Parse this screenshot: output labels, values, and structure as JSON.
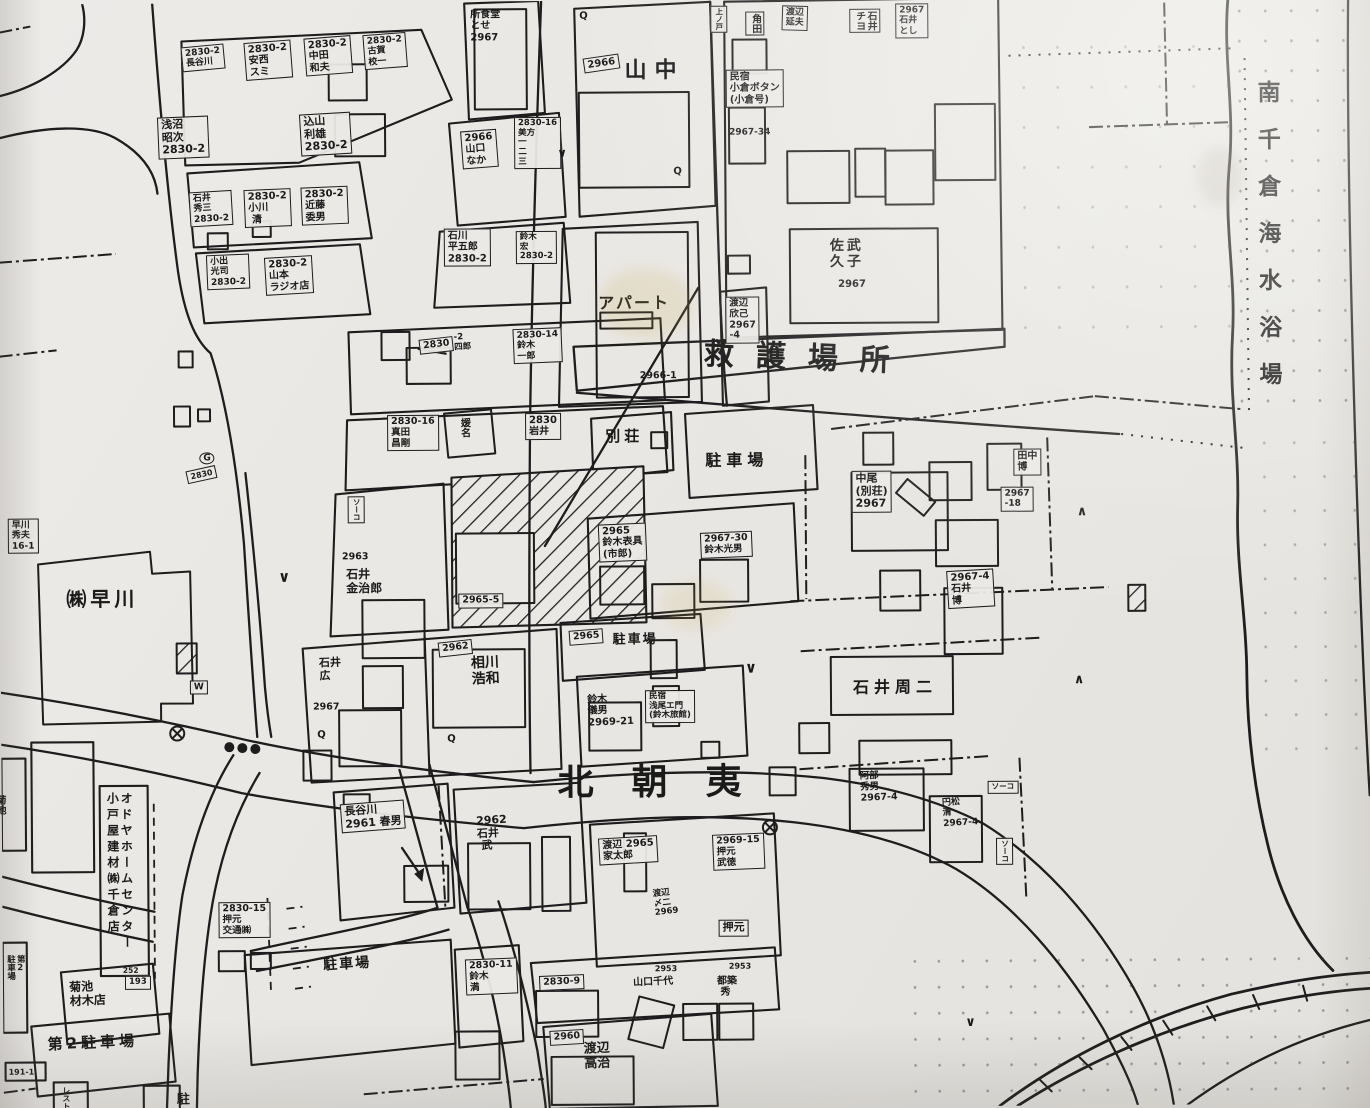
{
  "map": {
    "title": "南千倉住宅地図",
    "district_label": "北朝夷",
    "beach_label": "南千倉海水浴場",
    "labels": [
      {
        "t": "2830-2\n長谷川",
        "x": 184,
        "y": 44,
        "fs": 9,
        "b": 1,
        "r": -5
      },
      {
        "t": "2830-2\n安西\nスミ",
        "x": 247,
        "y": 40,
        "fs": 10,
        "b": 1,
        "r": -4
      },
      {
        "t": "2830-2\n中田\n和夫",
        "x": 307,
        "y": 36,
        "fs": 10,
        "b": 1,
        "r": -4
      },
      {
        "t": "2830-2\n古賀\n校一",
        "x": 366,
        "y": 33,
        "fs": 9,
        "b": 1,
        "r": -4
      },
      {
        "t": "浅沼\n昭次\n2830-2",
        "x": 160,
        "y": 114,
        "fs": 11,
        "b": 1,
        "r": -2
      },
      {
        "t": "込山\n利雄\n2830-2",
        "x": 302,
        "y": 112,
        "fs": 11,
        "b": 1,
        "r": -3
      },
      {
        "t": "石井\n秀三\n2830-2",
        "x": 191,
        "y": 189,
        "fs": 9,
        "b": 1,
        "r": -3
      },
      {
        "t": "2830-2\n小川\n 清",
        "x": 246,
        "y": 187,
        "fs": 10,
        "b": 1,
        "r": -2
      },
      {
        "t": "2830-2\n近藤\n委男",
        "x": 303,
        "y": 185,
        "fs": 10,
        "b": 1,
        "r": -2
      },
      {
        "t": "小出\n光司\n2830-2",
        "x": 208,
        "y": 252,
        "fs": 9,
        "b": 1,
        "r": -2
      },
      {
        "t": "2830-2\n山本\nラジオ店",
        "x": 266,
        "y": 255,
        "fs": 10,
        "b": 1,
        "r": -3
      },
      {
        "t": "2966\n山口\nなか",
        "x": 463,
        "y": 130,
        "fs": 10,
        "b": 1,
        "r": -4
      },
      {
        "t": "2830-16\n美方\n一\n二\n三",
        "x": 517,
        "y": 116,
        "fs": 8.5,
        "b": 1
      },
      {
        "t": "石川\n平五郎\n2830-2",
        "x": 446,
        "y": 227,
        "fs": 10,
        "b": 1
      },
      {
        "t": "鈴木\n宏\n2830-2",
        "x": 518,
        "y": 230,
        "fs": 8.5,
        "b": 1
      },
      {
        "t": "所食堂\nとせ\n2967",
        "x": 474,
        "y": 8,
        "fs": 10
      },
      {
        "t": "2966",
        "x": 586,
        "y": 58,
        "fs": 10,
        "b": 1,
        "r": -8
      },
      {
        "t": "山中",
        "x": 628,
        "y": 58,
        "fs": 22,
        "ls": 8
      },
      {
        "t": "上ノ戸",
        "x": 714,
        "y": 6,
        "fs": 7.5,
        "b": 1,
        "v": 1
      },
      {
        "t": "角田",
        "x": 749,
        "y": 12,
        "fs": 10,
        "b": 1,
        "v": 1
      },
      {
        "t": "渡辺\n延夫",
        "x": 786,
        "y": 6,
        "fs": 9,
        "b": 1,
        "r": 2
      },
      {
        "t": "石井\nチヨ",
        "x": 853,
        "y": 10,
        "fs": 10,
        "b": 1,
        "v": 1
      },
      {
        "t": "2967\n石井\nとし",
        "x": 899,
        "y": 5,
        "fs": 9,
        "b": 1
      },
      {
        "t": "民宿\n小倉ボタン\n(小倉号)",
        "x": 729,
        "y": 70,
        "fs": 10,
        "b": 1
      },
      {
        "t": "2967-34",
        "x": 732,
        "y": 128,
        "fs": 9
      },
      {
        "t": "佐武\n久子",
        "x": 832,
        "y": 240,
        "fs": 14,
        "ls": 3
      },
      {
        "t": "2967",
        "x": 840,
        "y": 280,
        "fs": 10
      },
      {
        "t": "南千倉海水浴場",
        "x": 1256,
        "y": 84,
        "fs": 23,
        "v": 1,
        "ls": 24,
        "n": "beach-label"
      },
      {
        "t": "2830",
        "x": 420,
        "y": 338,
        "fs": 9.5,
        "b": 1,
        "r": -6
      },
      {
        "t": "-2\n四郎",
        "x": 455,
        "y": 332,
        "fs": 8.5,
        "r": -3
      },
      {
        "t": "2830-14\n鈴木\n一郎",
        "x": 514,
        "y": 328,
        "fs": 9,
        "b": 1,
        "r": -2
      },
      {
        "t": "2966-1",
        "x": 641,
        "y": 371,
        "fs": 9.5
      },
      {
        "t": "2830-16\n真田\n昌剛",
        "x": 388,
        "y": 413,
        "fs": 9.5,
        "b": 1
      },
      {
        "t": "媛名",
        "x": 459,
        "y": 416,
        "fs": 10,
        "v": 1
      },
      {
        "t": "2830\n岩井",
        "x": 526,
        "y": 412,
        "fs": 10,
        "b": 1
      },
      {
        "t": "別荘",
        "x": 606,
        "y": 428,
        "fs": 15,
        "ls": 4
      },
      {
        "t": "駐車場",
        "x": 706,
        "y": 452,
        "fs": 16,
        "ls": 5,
        "n": "parking-label"
      },
      {
        "t": "渡辺\n欣己\n2967\n-4",
        "x": 727,
        "y": 297,
        "fs": 9.5,
        "b": 1
      },
      {
        "t": "救護場所",
        "x": 706,
        "y": 338,
        "fs": 30,
        "ls": 22,
        "r": 2.5,
        "n": "aid-station-label"
      },
      {
        "t": "ソーコ",
        "x": 348,
        "y": 494,
        "fs": 7.5,
        "b": 1,
        "v": 1
      },
      {
        "t": "2963",
        "x": 342,
        "y": 550,
        "fs": 9.5
      },
      {
        "t": "石井\n金治郎",
        "x": 346,
        "y": 566,
        "fs": 12
      },
      {
        "t": "2965-5",
        "x": 458,
        "y": 592,
        "fs": 9.5,
        "b": 1
      },
      {
        "t": "2965\n鈴木表具\n(市郎)",
        "x": 598,
        "y": 524,
        "fs": 10,
        "b": 1,
        "r": -2
      },
      {
        "t": "2967-30\n鈴木光男",
        "x": 700,
        "y": 533,
        "fs": 9.5,
        "b": 1,
        "r": -2
      },
      {
        "t": "中尾\n(別荘)\n2967",
        "x": 852,
        "y": 472,
        "fs": 11,
        "b": 1
      },
      {
        "t": "田中\n博",
        "x": 1014,
        "y": 451,
        "fs": 10,
        "b": 1
      },
      {
        "t": "2967\n-18",
        "x": 1001,
        "y": 489,
        "fs": 9,
        "b": 1
      },
      {
        "t": "2967-4\n石井\n博",
        "x": 946,
        "y": 573,
        "fs": 10,
        "b": 1,
        "r": -3
      },
      {
        "t": "石井周二",
        "x": 852,
        "y": 680,
        "fs": 16,
        "ls": 5
      },
      {
        "t": "2965",
        "x": 568,
        "y": 630,
        "fs": 9.5,
        "b": 1,
        "r": -4
      },
      {
        "t": "駐車場",
        "x": 612,
        "y": 633,
        "fs": 13,
        "ls": 2,
        "n": "parking-label"
      },
      {
        "t": "石井\n広",
        "x": 318,
        "y": 655,
        "fs": 11,
        "r": -2
      },
      {
        "t": "2967",
        "x": 312,
        "y": 700,
        "fs": 9.5
      },
      {
        "t": "2962",
        "x": 437,
        "y": 641,
        "fs": 9.5,
        "b": 1,
        "r": -6
      },
      {
        "t": "相川\n浩和",
        "x": 470,
        "y": 655,
        "fs": 14,
        "r": -2
      },
      {
        "t": "鈴木\n儀男\n2969-21",
        "x": 586,
        "y": 694,
        "fs": 10,
        "r": -2
      },
      {
        "t": "民宿\n浅尾エ門\n(鈴木旅館)",
        "x": 644,
        "y": 690,
        "fs": 8.5,
        "b": 1
      },
      {
        "t": "北朝夷",
        "x": 556,
        "y": 762,
        "fs": 36,
        "ls": 38,
        "n": "district-label"
      },
      {
        "t": "阿部\n秀男\n2967-4",
        "x": 858,
        "y": 773,
        "fs": 9.5,
        "r": -2
      },
      {
        "t": "円松\n清\n2967-4",
        "x": 940,
        "y": 800,
        "fs": 9,
        "r": -3
      },
      {
        "t": "ソーコ",
        "x": 986,
        "y": 783,
        "fs": 7.5,
        "b": 1
      },
      {
        "t": "ソーコ",
        "x": 994,
        "y": 840,
        "fs": 7.5,
        "b": 1,
        "v": 1
      },
      {
        "t": "オドヤホームセンター\n小戸屋建材㈱千倉店",
        "x": 103,
        "y": 788,
        "fs": 12,
        "v": 1,
        "ls": 4
      },
      {
        "t": "252",
        "x": 120,
        "y": 963,
        "fs": 7.5
      },
      {
        "t": "2830-15\n押元\n交通㈱",
        "x": 216,
        "y": 899,
        "fs": 9.5,
        "b": 1
      },
      {
        "t": "菊池\n材木店",
        "x": 66,
        "y": 977,
        "fs": 12,
        "r": -2
      },
      {
        "t": "193",
        "x": 122,
        "y": 972,
        "fs": 8.5,
        "b": 1
      },
      {
        "t": "第2駐車場",
        "x": 44,
        "y": 1032,
        "fs": 15,
        "ls": 4,
        "r": -2,
        "n": "parking2-label"
      },
      {
        "t": "第2\n駐車場",
        "x": 2,
        "y": 950,
        "fs": 8.5,
        "v": 1
      },
      {
        "t": "191-1",
        "x": 5,
        "y": 1063,
        "fs": 8
      },
      {
        "t": "レストラン",
        "x": 58,
        "y": 1082,
        "fs": 8,
        "v": 1
      },
      {
        "t": "駐",
        "x": 173,
        "y": 1090,
        "fs": 13
      },
      {
        "t": "駐車場",
        "x": 320,
        "y": 956,
        "fs": 14,
        "ls": 2,
        "r": -3,
        "n": "parking-label"
      },
      {
        "t": "長谷川\n2961 春男",
        "x": 338,
        "y": 802,
        "fs": 11,
        "b": 1,
        "r": -4
      },
      {
        "t": "2962\n石井\n 武",
        "x": 474,
        "y": 814,
        "fs": 11,
        "r": -3
      },
      {
        "t": "渡辺 2965\n家太郎",
        "x": 596,
        "y": 838,
        "fs": 10,
        "b": 1,
        "r": -3
      },
      {
        "t": "2969-15\n押元\n武徳",
        "x": 710,
        "y": 835,
        "fs": 9.5,
        "b": 1,
        "r": -2
      },
      {
        "t": "渡辺\n〆二\n2969",
        "x": 650,
        "y": 890,
        "fs": 8.5,
        "r": -6
      },
      {
        "t": "押元",
        "x": 716,
        "y": 920,
        "fs": 11,
        "b": 1
      },
      {
        "t": "2830-11\n鈴木\n満",
        "x": 462,
        "y": 958,
        "fs": 9.5,
        "b": 1,
        "r": -2
      },
      {
        "t": "2830-9",
        "x": 536,
        "y": 975,
        "fs": 9.5,
        "b": 1,
        "r": -2
      },
      {
        "t": "2960",
        "x": 546,
        "y": 1030,
        "fs": 9.5,
        "b": 1,
        "r": -3
      },
      {
        "t": "渡辺\n高治",
        "x": 580,
        "y": 1042,
        "fs": 13,
        "r": -2
      },
      {
        "t": "2953",
        "x": 652,
        "y": 964,
        "fs": 8
      },
      {
        "t": "山口千代",
        "x": 630,
        "y": 977,
        "fs": 10,
        "r": -2
      },
      {
        "t": "2953",
        "x": 726,
        "y": 962,
        "fs": 8
      },
      {
        "t": "都築\n 秀",
        "x": 714,
        "y": 976,
        "fs": 10
      },
      {
        "t": "早川\n秀夫\n16-1",
        "x": 8,
        "y": 514,
        "fs": 9,
        "b": 1
      },
      {
        "t": "㈱早川",
        "x": 66,
        "y": 584,
        "fs": 20,
        "ls": 4,
        "n": "hayakawa-company-label"
      },
      {
        "t": "W",
        "x": 189,
        "y": 677,
        "fs": 9,
        "b": 1
      },
      {
        "t": "2830",
        "x": 186,
        "y": 468,
        "fs": 8,
        "b": 1,
        "r": -12
      },
      {
        "t": "G",
        "x": 200,
        "y": 449,
        "fs": 9,
        "b": 1,
        "round": 1
      },
      {
        "t": "菊池",
        "x": -8,
        "y": 790,
        "fs": 10,
        "v": 1
      },
      {
        "t": "アパート",
        "x": 600,
        "y": 294,
        "fs": 16,
        "ls": 2
      },
      {
        "t": "∨",
        "x": 278,
        "y": 566,
        "fs": 15
      },
      {
        "t": "∨",
        "x": 744,
        "y": 660,
        "fs": 15
      },
      {
        "t": "∧",
        "x": 1077,
        "y": 508,
        "fs": 13
      },
      {
        "t": "∧",
        "x": 1073,
        "y": 676,
        "fs": 13
      },
      {
        "t": "∨",
        "x": 962,
        "y": 1018,
        "fs": 13
      },
      {
        "t": "∨",
        "x": 560,
        "y": 146,
        "fs": 12
      },
      {
        "t": "Q",
        "x": 583,
        "y": 10,
        "fs": 10
      },
      {
        "t": "Q",
        "x": 676,
        "y": 166,
        "fs": 10
      },
      {
        "t": "Q",
        "x": 316,
        "y": 727,
        "fs": 10
      },
      {
        "t": "Q",
        "x": 446,
        "y": 732,
        "fs": 10
      }
    ]
  }
}
